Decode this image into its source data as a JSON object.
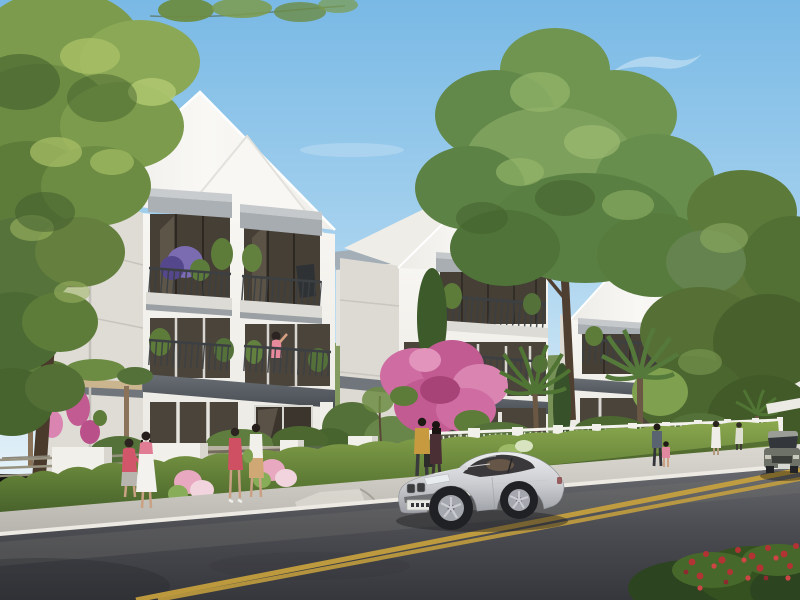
{
  "meta": {
    "type": "architectural-rendering",
    "description": "Sunny 3D rendering of a row of white three-storey garden villas along a tree-lined street. Residents stroll on a light concrete sidewalk behind a low white fence and clipped hedge while a silver coupe drives along a dark asphalt road marked with a double yellow center line.",
    "canvas": {
      "width": 800,
      "height": 600
    }
  },
  "palette": {
    "sky_top": "#79b9e5",
    "sky_mid": "#a5d1ee",
    "sky_horizon": "#e4f1f8",
    "house_wall": "#f5f4f0",
    "house_wall_shade": "#dcdad4",
    "roof_white": "#f7f6f3",
    "roof_gray_blue": "#a3aeb7",
    "trim_dark_gray": "#51565c",
    "canopy_gray": "#a8aeb2",
    "railing": "#3a3e41",
    "glass": "#453f36",
    "foliage_light": "#a9c167",
    "foliage_mid": "#6d8c43",
    "foliage_dark": "#3f5a2d",
    "bougainvillea_pink": "#cf6da2",
    "hedge_top": "#85a34c",
    "hedge_base": "#3f5827",
    "sidewalk": "#cfcdc5",
    "curb": "#eceae3",
    "road_light": "#63646a",
    "road_dark": "#3a3b40",
    "center_line_yellow": "#c9a23e",
    "car_silver": "#d9dadc",
    "distant_car_gray": "#6d7168",
    "flower_red": "#b33334",
    "plaque_gold": "#c9a227"
  },
  "scene": {
    "sky": {
      "label": "clear blue sky with faint wispy clouds"
    },
    "houses": [
      {
        "id": "villa-1",
        "label": "foreground three-storey white villa with double gable roof, gray window canopies, dark-railed balconies with purple and green planters, pergola with pink bougainvillea"
      },
      {
        "id": "villa-2",
        "label": "matching white villa further down the street with balconies and potted plants"
      },
      {
        "id": "villa-3",
        "label": "third matching villa partly hidden behind street trees"
      }
    ],
    "vegetation": [
      "large leafy tree at the left edge",
      "tall tree rising behind the villas",
      "street trees on the right",
      "clipped hedge running along the fence",
      "palm trees in the front gardens",
      "pink flowering shrub and columnar cypresses",
      "red flowering bush in the lower right corner"
    ],
    "street": {
      "fence": "white pillars with slatted and vertical-bar infill panels, slatted gate, small gold plaque on one pillar",
      "sidewalk": "light concrete sidewalk with white curb and driveway ramp",
      "road": "dark asphalt road",
      "marking": "double yellow center line"
    },
    "people": [
      {
        "id": "stroller-1",
        "label": "woman in coral top and gray skirt walking by the hedge"
      },
      {
        "id": "stroller-2",
        "label": "woman in white dress with pink top walking beside her"
      },
      {
        "id": "gate-1",
        "label": "woman in coral dress chatting at the gate"
      },
      {
        "id": "gate-2",
        "label": "woman in white top, tan skirt and green bag at the gate"
      },
      {
        "id": "balcony",
        "label": "woman in pink waving from a second-floor balcony"
      },
      {
        "id": "fence-couple-1",
        "label": "man in mustard jacket standing at the fence"
      },
      {
        "id": "fence-couple-2",
        "label": "woman in dark dress beside him"
      },
      {
        "id": "walker-adult",
        "label": "adult walking with a child in pink further down the sidewalk"
      },
      {
        "id": "walker-white",
        "label": "woman in white in the distance"
      }
    ],
    "vehicles": [
      {
        "id": "coupe",
        "label": "silver coupe driving along the road toward the left",
        "license_plate": "illegible"
      },
      {
        "id": "sedan",
        "label": "dark gray sedan approaching in the distance at the right edge"
      }
    ]
  }
}
